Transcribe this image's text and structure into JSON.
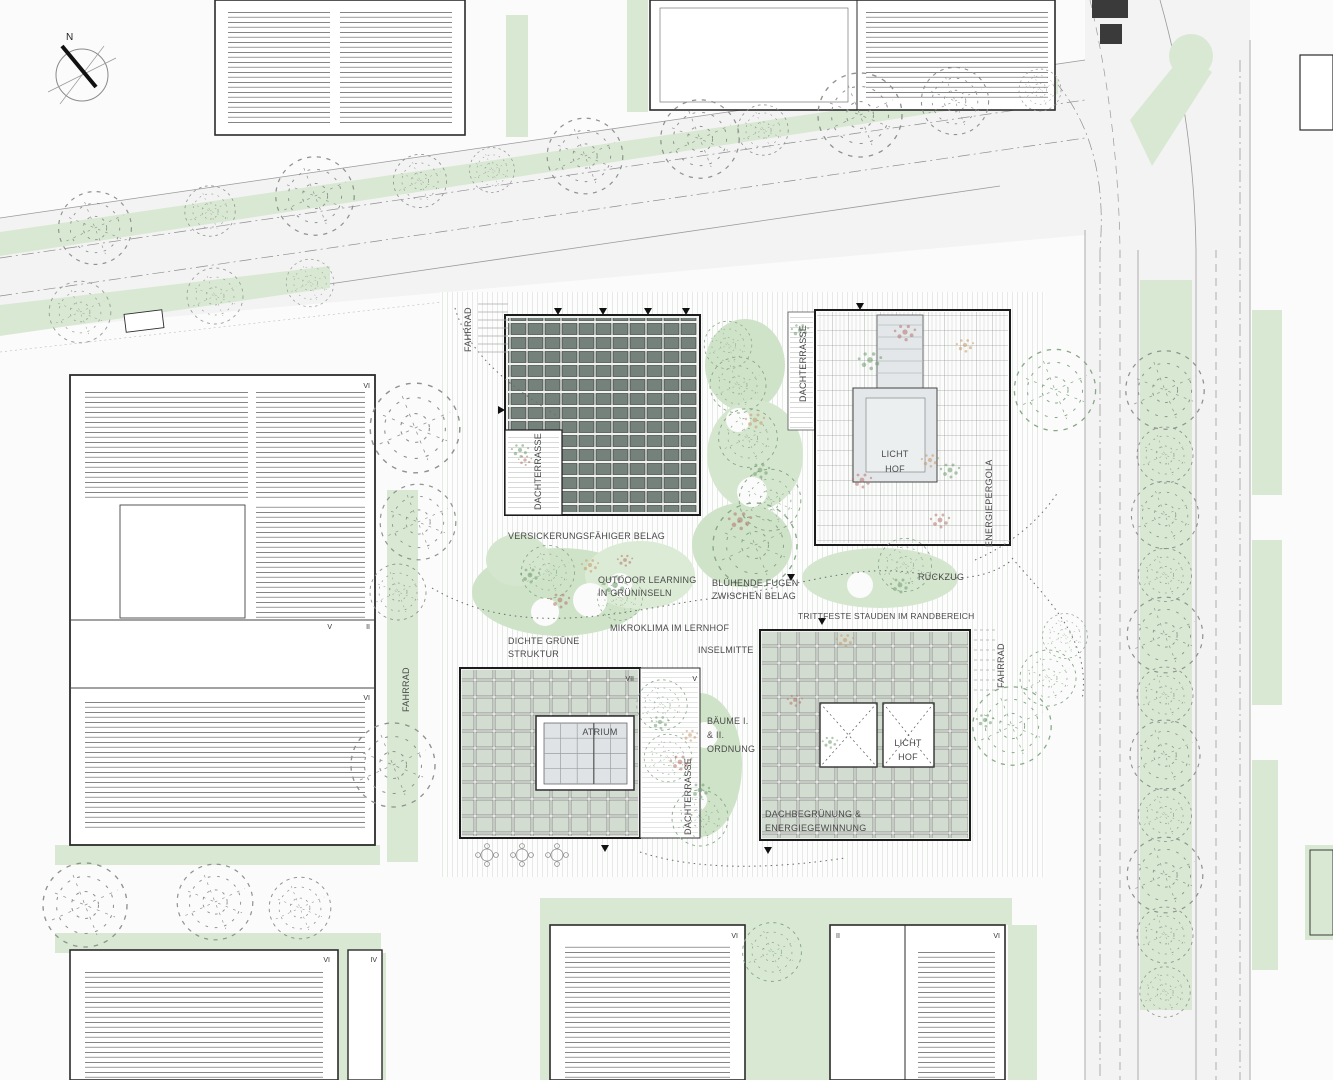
{
  "compass": {
    "north": "N"
  },
  "labels": {
    "fahrrad": "FAHRRAD",
    "dachterrasse": "DACHTERRASSE",
    "energiepergola": "ENERGIEPERGOLA",
    "versickerung": "VERSICKERUNGSFÄHIGER BELAG",
    "outdoor1": "OUTDOOR LEARNING",
    "outdoor2": "IN GRÜNINSELN",
    "bluehende1": "BLÜHENDE FUGEN",
    "bluehende2": "ZWISCHEN BELAG",
    "rueckzug": "RÜCKZUG",
    "trittfeste": "TRITTFESTE STAUDEN IM RANDBEREICH",
    "mikroklima": "MIKROKLIMA IM LERNHOF",
    "dichte1": "DICHTE GRÜNE",
    "dichte2": "STRUKTUR",
    "inselmitte": "INSELMITTE",
    "baeume1": "BÄUME I.",
    "baeume2": "& II.",
    "baeume3": "ORDNUNG",
    "licht": "LICHT",
    "hof": "HOF",
    "atrium": "ATRIUM",
    "dachbegruenung1": "DACHBEGRÜNUNG &",
    "dachbegruenung2": "ENERGIEGEWINNUNG"
  },
  "numerals": {
    "left_top": "VI",
    "left_mid_a": "V",
    "left_mid_b": "II",
    "left_low": "VI",
    "bottomleft_a": "VI",
    "bottomleft_b": "IV",
    "bottomcenter": "VI",
    "bottomright_a": "II",
    "bottomright_b": "VI",
    "atrium_building": "VII",
    "terrace_strip": "V"
  },
  "colors": {
    "green_light": "#d9e8d3",
    "green_island": "#cfe3c8",
    "solar_panel": "#75827b",
    "sage_panel": "#d3dcd0",
    "glass": "#dfe3e6",
    "courtyard_gray": "#e3e7e9",
    "outline": "#2b2b2b",
    "road_line": "#8f8f8f",
    "accent_red": "#b5746c",
    "accent_orange": "#c79a6b",
    "accent_green": "#6f9c6f"
  }
}
